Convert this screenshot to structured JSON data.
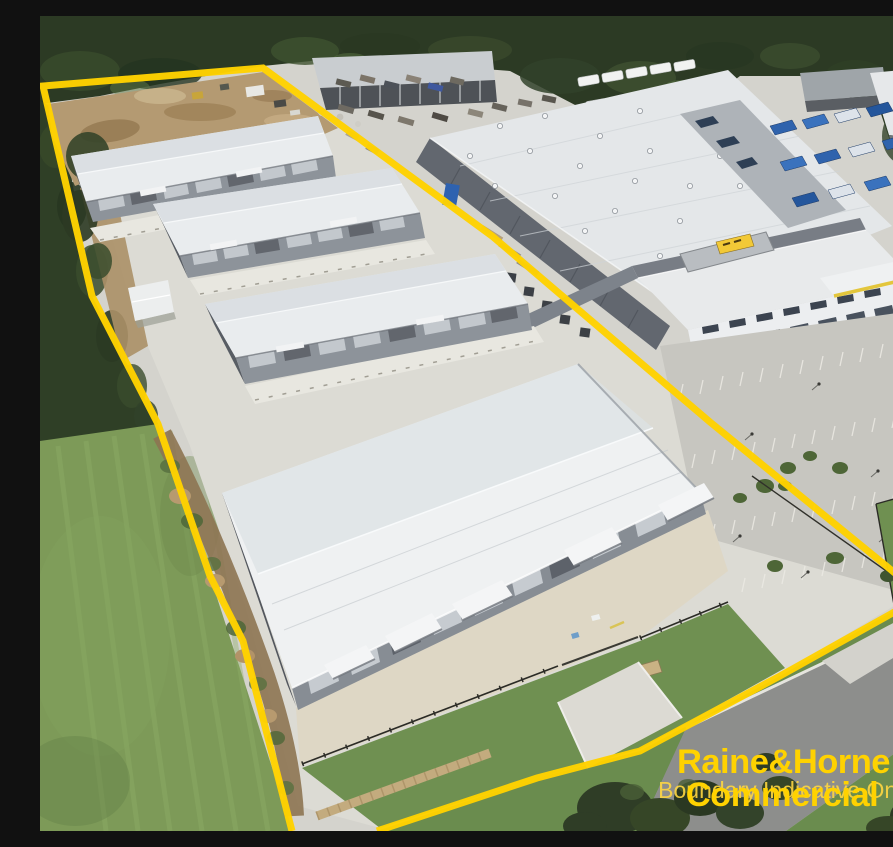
{
  "meta": {
    "kind": "aerial-photograph",
    "width_px": 893,
    "height_px": 815,
    "subject": "Aerial view of a new industrial warehouse estate outlined with a yellow site boundary"
  },
  "overlay": {
    "disclaimer": "Boundary Indicative Only",
    "brand_line1": "Raine&Horne",
    "brand_registered": "®",
    "brand_line2": "Commercial"
  },
  "palette": {
    "boundary_yellow": "#FFD200",
    "watermark_yellow": "#FFD742",
    "forest_green": "#2C3A24",
    "grass_green": "#7D9A58",
    "dirt_tan": "#B49A72",
    "concrete_grey": "#D6D5CF",
    "roof_white": "#E9ECEE",
    "wall_grey": "#8D939A",
    "road_grey": "#8D8E8C"
  },
  "scene": {
    "site_warehouses_count": 4,
    "elements": [
      "yellow site boundary outline",
      "cleared dirt pad with machinery",
      "four white warehouse buildings with roller doors",
      "small white shed",
      "concrete hardstand",
      "security fencing and gate",
      "neighbouring distribution centre with office wing",
      "rooftop yellow sign",
      "trailer and equipment yard",
      "blue storage bins",
      "car park with line markings",
      "street with grass verge",
      "grass paddock",
      "surrounding bushland"
    ]
  }
}
